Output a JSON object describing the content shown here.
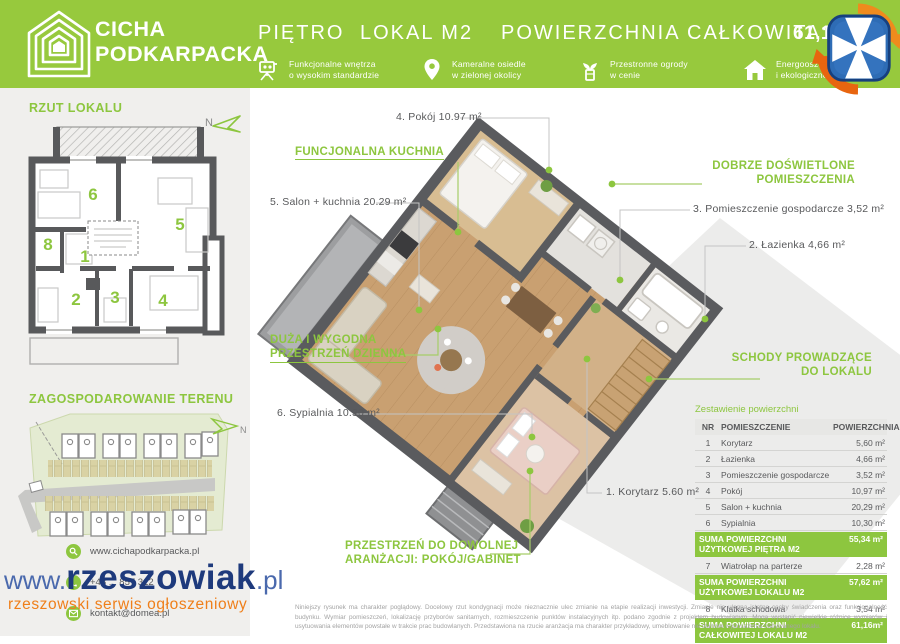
{
  "header": {
    "brand_line1": "CICHA",
    "brand_line2": "PODKARPACKA",
    "title_floor": "PIĘTRO",
    "title_unit": "LOKAL M2",
    "title_area_label": "POWIERZCHNIA CAŁKOWITA:",
    "title_area_value": "61,16 m²",
    "features": [
      {
        "icon": "projector-icon",
        "line1": "Funkcjonalne wnętrza",
        "line2": "o wysokim standardzie"
      },
      {
        "icon": "location-pin-icon",
        "line1": "Kameralne osiedle",
        "line2": "w zielonej okolicy"
      },
      {
        "icon": "plant-icon",
        "line1": "Przestronne ogrody",
        "line2": "w cenie"
      },
      {
        "icon": "house-icon",
        "line1": "Energooszczędne",
        "line2": "i ekologiczne budownictwo"
      }
    ]
  },
  "sidebar": {
    "plan_title": "RZUT LOKALU",
    "site_title": "ZAGOSPODAROWANIE TERENU",
    "north_label": "N",
    "room_numbers": [
      "1",
      "2",
      "3",
      "4",
      "5",
      "6",
      "8"
    ],
    "contacts": [
      {
        "icon": "search-icon",
        "text": "www.cichapodkarpacka.pl"
      },
      {
        "icon": "phone-icon",
        "text": "+48 ... 857 312"
      },
      {
        "icon": "email-icon",
        "text": "kontakt@domea.pl"
      }
    ]
  },
  "plan": {
    "green_labels": [
      {
        "line1": "FUNCJONALNA KUCHNIA",
        "line2": ""
      },
      {
        "line1": "DOBRZE DOŚWIETLONE",
        "line2": "POMIESZCZENIA"
      },
      {
        "line1": "SCHODY PROWADZĄCE",
        "line2": "DO LOKALU"
      },
      {
        "line1": "DUŻA I WYGODNA",
        "line2": "PRZESTRZEŃ DZIENNA"
      },
      {
        "line1": "PRZESTRZEŃ DO DOWOLNEJ",
        "line2": "ARANŻACJI: POKÓJ/GABINET"
      }
    ],
    "room_labels": [
      "4. Pokój 10.97 m²",
      "5. Salon + kuchnia 20.29 m²",
      "3. Pomieszczenie gospodarcze 3,52 m²",
      "2. Łazienka 4,66 m²",
      "6. Sypialnia 10.30 m²",
      "1. Korytarz 5.60 m²"
    ]
  },
  "table": {
    "title": "Zestawienie powierzchni",
    "headers": [
      "NR",
      "POMIESZCZENIE",
      "POWIERZCHNIA"
    ],
    "rows": [
      {
        "nr": "1",
        "name": "Korytarz",
        "value": "5,60 m²"
      },
      {
        "nr": "2",
        "name": "Łazienka",
        "value": "4,66 m²"
      },
      {
        "nr": "3",
        "name": "Pomieszczenie gospodarcze",
        "value": "3,52 m²"
      },
      {
        "nr": "4",
        "name": "Pokój",
        "value": "10,97 m²"
      },
      {
        "nr": "5",
        "name": "Salon + kuchnia",
        "value": "20,29 m²"
      },
      {
        "nr": "6",
        "name": "Sypialnia",
        "value": "10,30 m²"
      },
      {
        "nr": "7",
        "name": "Wiatrołap na parterze",
        "value": "2,28 m²"
      },
      {
        "nr": "8",
        "name": "Klatka schodowa",
        "value": "3,54 m²"
      }
    ],
    "summaries": [
      {
        "label": "SUMA POWIERZCHNI UŻYTKOWEJ PIĘTRA M2",
        "value": "55,34 m²"
      },
      {
        "label": "SUMA POWIERZCHNI UŻYTKOWEJ LOKALU M2",
        "value": "57,62 m²"
      },
      {
        "label": "SUMA POWIERZCHNI CAŁKOWITEJ LOKALU M2",
        "value": "61,16m²"
      }
    ]
  },
  "watermark": {
    "www": "www.",
    "name": "rzeszowiak",
    "tld": ".pl",
    "subtitle": "rzeszowski serwis ogłoszeniowy"
  },
  "disclaimer": "Niniejszy rysunek ma charakter poglądowy. Docelowy rzut kondygnacji może nieznacznie ulec zmianie na etapie realizacji inwestycji. Zmianie nie ulegną istotne cechy świadczenia oraz funkcjonalność budynku. Wymiar pomieszczeń, lokalizację przyborów sanitarnych, rozmieszczenie punktów instalacyjnych itp. podano zgodnie z projektem budowlanym. Mogą wystąpić niewielkie różnice wymiarów i usytuowania elementów powstałe w trakcie prac budowlanych. Przedstawiona na rzucie aranżacja ma charakter przykładowy, umeblowanie nie stanowi wyposażenia nabywanego lokalu.",
  "colors": {
    "green": "#97c93d",
    "accent_green": "#8dc63f",
    "wall_gray": "#5a5b5e",
    "navy": "#1e3a7c",
    "orange": "#ef7f1a"
  }
}
